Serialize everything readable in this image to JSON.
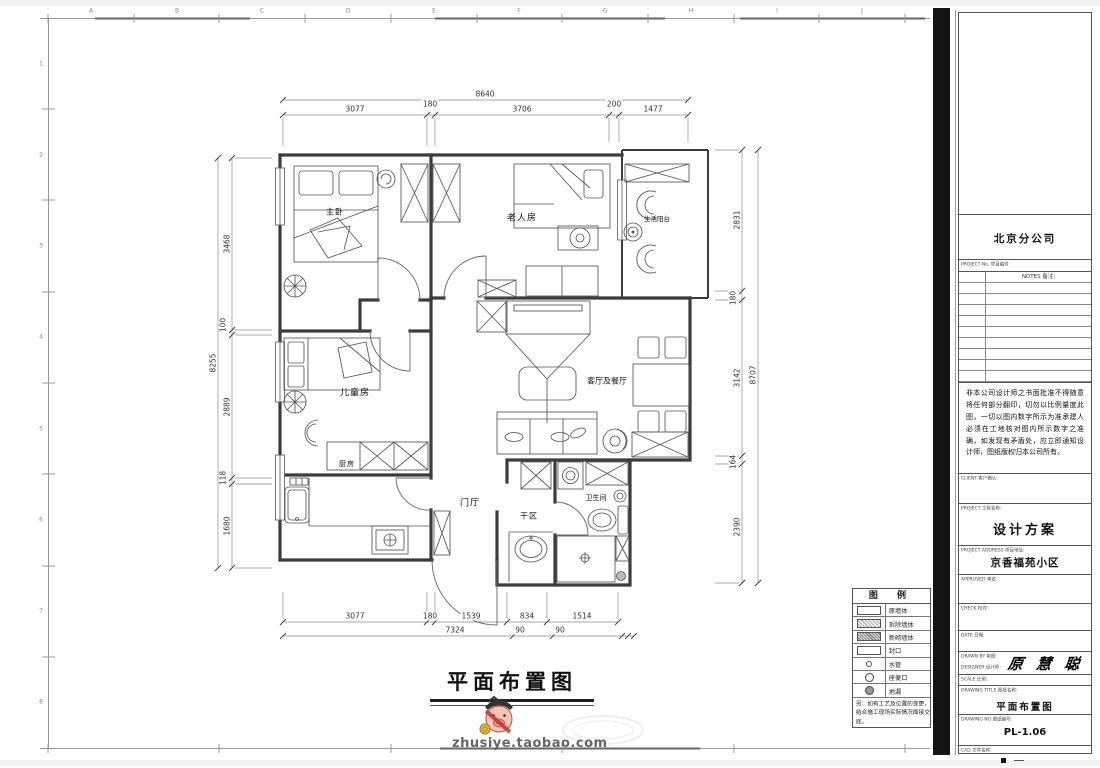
{
  "sheet": {
    "grid_letters": [
      "A",
      "B",
      "C",
      "D",
      "E",
      "F",
      "G",
      "H",
      "I",
      "J"
    ],
    "grid_numbers": [
      "1",
      "2",
      "3",
      "4",
      "5",
      "6",
      "7",
      "8"
    ]
  },
  "plan": {
    "title": "平面布置图",
    "rooms": {
      "master_bedroom": "主卧",
      "elder_room": "老人房",
      "balcony": "生活阳台",
      "kids_room": "儿童房",
      "living_dining": "客厅及餐厅",
      "kitchen": "厨房",
      "foyer": "门厅",
      "dry_area": "干区",
      "bathroom": "卫生间"
    },
    "dims": {
      "top_total": "8640",
      "top": [
        "3077",
        "180",
        "3706",
        "200",
        "1477"
      ],
      "left_total": "8255",
      "left": [
        "3468",
        "100",
        "2889",
        "118",
        "1680"
      ],
      "right_total": "8707",
      "right": [
        "2831",
        "180",
        "3142",
        "164",
        "2390"
      ],
      "bottom": [
        "3077",
        "180",
        "1539",
        "834",
        "1514"
      ],
      "bottom_total": "7324",
      "bottom_extra": [
        "90",
        "90"
      ]
    }
  },
  "legend": {
    "title": "图 例",
    "items": [
      {
        "symbol": "rect-plain",
        "label": "原墙体"
      },
      {
        "symbol": "rect-hatch-light",
        "label": "拆除墙体"
      },
      {
        "symbol": "rect-hatch-dark",
        "label": "新砌墙体"
      },
      {
        "symbol": "rect-plain",
        "label": "封口"
      },
      {
        "symbol": "circle-small",
        "label": "水管"
      },
      {
        "symbol": "circle",
        "label": "座便口"
      },
      {
        "symbol": "circle-filled",
        "label": "地漏"
      }
    ],
    "note": "另：如有工艺及位置的变更，结合施工现场实际情况面接交底。"
  },
  "titleblock": {
    "company": "北京分公司",
    "project_no_label": "PROJECT No. 项目编号",
    "notes_label": "NOTES 备注:",
    "disclaimer": "非本公司设计师之书面批准不得随意将任何部分翻印，切勿以比例量度此图，一切以图内数字所示为准承建人必须在工地核对图内所示数字之准确，如发现有矛盾处，应立即通知设计师，图纸版权归本公司所有。",
    "fields": {
      "client_label": "CLIENT 客户确认:",
      "project_label": "PROJECT 工程名称:",
      "project_value": "设计方案",
      "address_label": "PROJECT ADDRESS 项目地址:",
      "address_value": "京香福苑小区",
      "approved_label": "APPROVED 审定:",
      "check_label": "CHECK 校对:",
      "date_label": "DATE 日期:",
      "drawn_label": "DRAWN BY 制图:",
      "designer_label": "DESIGNER 设计师:",
      "signature": "原 慧 聪",
      "scale_label": "SCALE 比例:",
      "title_label": "DRAWING TITLE 图纸名称:",
      "title_value": "平面布置图",
      "no_label": "DRAWING NO 图纸编号:",
      "no_value": "PL-1.06",
      "cad_label": "CAD 文件名称:"
    }
  },
  "watermark": {
    "text": "zhusiye.taobao.com"
  }
}
